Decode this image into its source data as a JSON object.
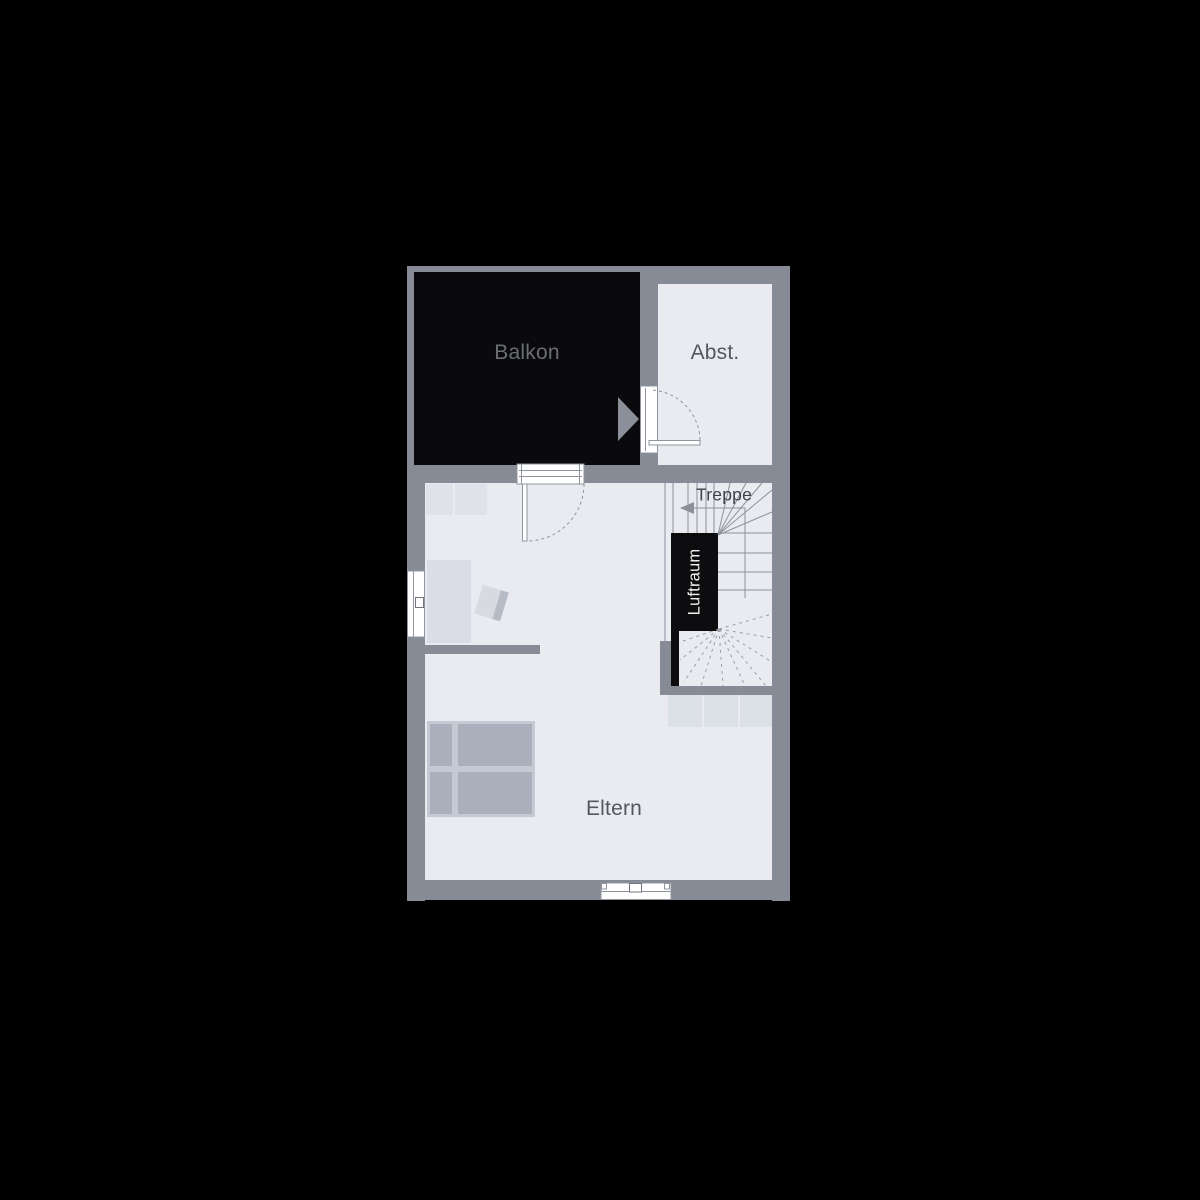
{
  "labels": {
    "balkon": "Balkon",
    "abst": "Abst.",
    "treppe": "Treppe",
    "luftraum": "Luftraum",
    "eltern": "Eltern"
  },
  "colors": {
    "background": "#000000",
    "wall": "#868b96",
    "floor": "#e9ebf0",
    "balcony_floor": "#0a0a0c",
    "void_black": "#0d0d0f",
    "furniture": "#dde0e7",
    "bed_frame": "#c5c9d3",
    "bed_inner": "#aab0bb",
    "stair_line": "#8d929b",
    "door_window_line": "#8f949e",
    "label_text": "#54575d",
    "label_on_dark": "#6a6e74",
    "luftraum_text": "#f2f2f2",
    "window_white": "#ffffff"
  }
}
